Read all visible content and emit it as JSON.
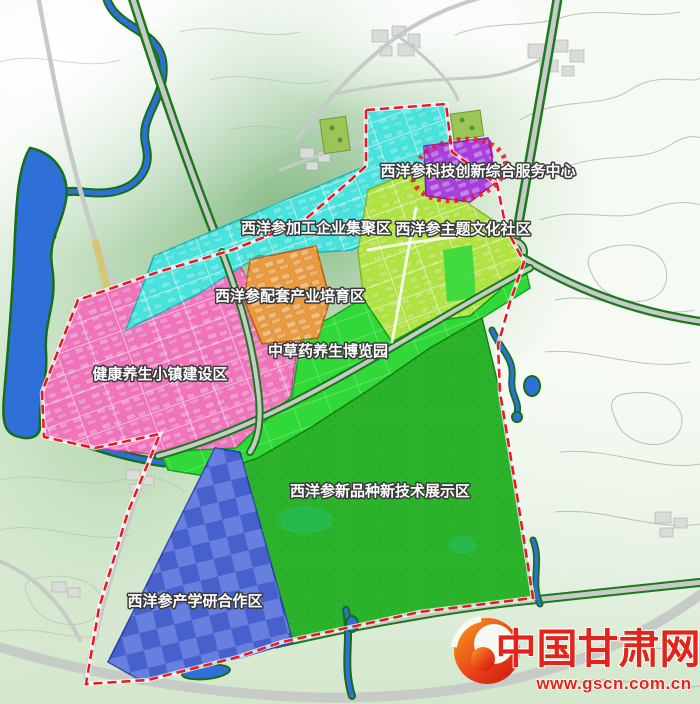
{
  "map": {
    "boundary_color": "#ee1520",
    "zones": [
      {
        "name": "tech-service-center",
        "label": "西洋参科技创新综合服务中心",
        "color": "#a93ddd"
      },
      {
        "name": "processing-cluster",
        "label": "西洋参加工企业集聚区",
        "color": "#45e4de"
      },
      {
        "name": "culture-community",
        "label": "西洋参主题文化社区",
        "color": "#b0e440"
      },
      {
        "name": "support-industry",
        "label": "西洋参配套产业培育区",
        "color": "#eb9b3d"
      },
      {
        "name": "health-town",
        "label": "健康养生小镇建设区",
        "color": "#f273bc"
      },
      {
        "name": "herb-expo-park",
        "label": "中草药养生博览园",
        "color": "#30d838"
      },
      {
        "name": "demo-area",
        "label": "西洋参新品种新技术展示区",
        "color": "#2cb32c"
      },
      {
        "name": "research-cooperation",
        "label": "西洋参产学研合作区",
        "color": "#4e6ad9"
      }
    ]
  },
  "watermark": {
    "site_name": "中国甘肃网",
    "site_url": "www.gscn.com.cn",
    "color": "#e1251b"
  }
}
